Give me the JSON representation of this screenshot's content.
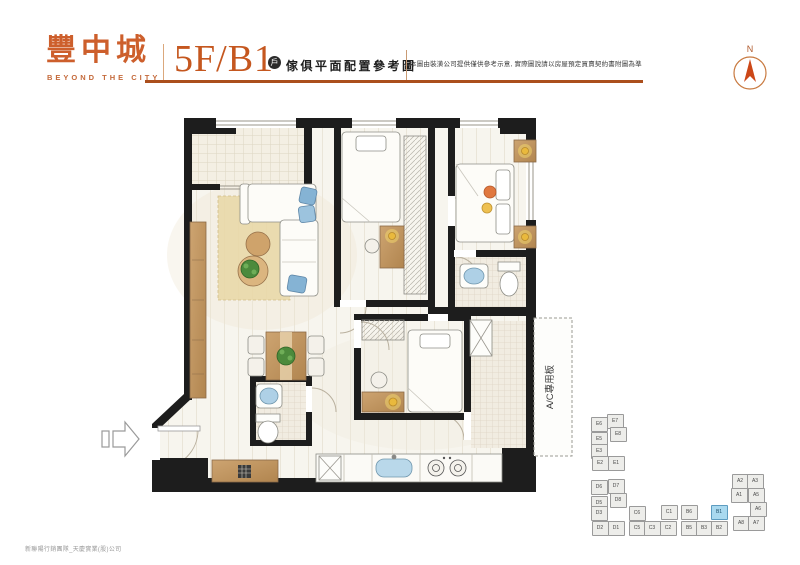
{
  "brand": {
    "logo_text": "豐中城",
    "logo_subtitle": "BEYOND THE CITY"
  },
  "header": {
    "unit_title": "5F/B1",
    "badge": "戶",
    "subtitle": "傢俱平面配置參考圖",
    "disclaimer": "本圖由裝潢公司提供僅供參考示意, 實際圖說請以房屋預定買賣契約書附圖為準",
    "compass_label": "N"
  },
  "plan": {
    "ac_label": "A/C專用板"
  },
  "footer": {
    "credit": "新聯陽行銷團隊_天慶實業(股)公司"
  },
  "keyplan": {
    "unit_color": "#ededea",
    "highlight_color": "#a9d9ef",
    "highlighted_unit": "B1",
    "units": [
      {
        "label": "E6",
        "x": 598,
        "y": 423,
        "hl": false
      },
      {
        "label": "E7",
        "x": 614,
        "y": 420,
        "hl": false
      },
      {
        "label": "E5",
        "x": 598,
        "y": 438,
        "hl": false
      },
      {
        "label": "E8",
        "x": 617,
        "y": 433,
        "hl": false
      },
      {
        "label": "E3",
        "x": 598,
        "y": 450,
        "hl": false
      },
      {
        "label": "E2",
        "x": 599,
        "y": 462,
        "hl": false
      },
      {
        "label": "E1",
        "x": 615,
        "y": 462,
        "hl": false
      },
      {
        "label": "D6",
        "x": 598,
        "y": 486,
        "hl": false
      },
      {
        "label": "D7",
        "x": 615,
        "y": 485,
        "hl": false
      },
      {
        "label": "D5",
        "x": 598,
        "y": 502,
        "hl": false
      },
      {
        "label": "D8",
        "x": 617,
        "y": 499,
        "hl": false
      },
      {
        "label": "D3",
        "x": 598,
        "y": 512,
        "hl": false
      },
      {
        "label": "D2",
        "x": 599,
        "y": 527,
        "hl": false
      },
      {
        "label": "D1",
        "x": 615,
        "y": 527,
        "hl": false
      },
      {
        "label": "C6",
        "x": 636,
        "y": 512,
        "hl": false
      },
      {
        "label": "C1",
        "x": 668,
        "y": 511,
        "hl": false
      },
      {
        "label": "C5",
        "x": 636,
        "y": 527,
        "hl": false
      },
      {
        "label": "C3",
        "x": 651,
        "y": 527,
        "hl": false
      },
      {
        "label": "C2",
        "x": 667,
        "y": 527,
        "hl": false
      },
      {
        "label": "B6",
        "x": 688,
        "y": 511,
        "hl": false
      },
      {
        "label": "B1",
        "x": 718,
        "y": 511,
        "hl": true
      },
      {
        "label": "B5",
        "x": 688,
        "y": 527,
        "hl": false
      },
      {
        "label": "B3",
        "x": 703,
        "y": 527,
        "hl": false
      },
      {
        "label": "B2",
        "x": 718,
        "y": 527,
        "hl": false
      },
      {
        "label": "A2",
        "x": 739,
        "y": 480,
        "hl": false
      },
      {
        "label": "A3",
        "x": 754,
        "y": 480,
        "hl": false
      },
      {
        "label": "A1",
        "x": 738,
        "y": 494,
        "hl": false
      },
      {
        "label": "A5",
        "x": 755,
        "y": 494,
        "hl": false
      },
      {
        "label": "A6",
        "x": 757,
        "y": 508,
        "hl": false
      },
      {
        "label": "A8",
        "x": 740,
        "y": 522,
        "hl": false
      },
      {
        "label": "A7",
        "x": 755,
        "y": 522,
        "hl": false
      }
    ]
  },
  "colors": {
    "brand_orange": "#cd5f2c",
    "rule_orange": "#ab4f1d",
    "wall_black": "#1d1d1d",
    "highlight_blue": "#a9d9ef"
  }
}
